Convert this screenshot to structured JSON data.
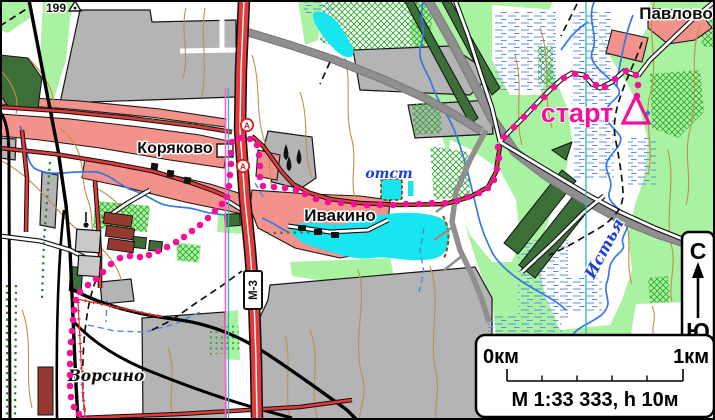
{
  "map": {
    "place_labels": {
      "pavlovo": "Павлово",
      "koryakovo": "Коряково",
      "ivakino": "Ивакино",
      "vorsino": "Ворсино"
    },
    "other_labels": {
      "elevation_point": "199",
      "highway_label": "М-3",
      "start_label": "старт",
      "pond_label": "отст",
      "river_label": "Истья"
    },
    "bus_stop_letter": "А",
    "route": {
      "color": "#f5109b",
      "start_triangle": [
        [
          636,
          96
        ],
        [
          649,
          123
        ],
        [
          623,
          123
        ]
      ],
      "points": [
        [
          637,
          96
        ],
        [
          638,
          85
        ],
        [
          636,
          75
        ],
        [
          626,
          71
        ],
        [
          615,
          79
        ],
        [
          605,
          87
        ],
        [
          596,
          85
        ],
        [
          586,
          77
        ],
        [
          575,
          74
        ],
        [
          564,
          78
        ],
        [
          554,
          87
        ],
        [
          544,
          97
        ],
        [
          534,
          107
        ],
        [
          524,
          117
        ],
        [
          514,
          127
        ],
        [
          504,
          137
        ],
        [
          498,
          147
        ],
        [
          499,
          158
        ],
        [
          497,
          169
        ],
        [
          494,
          180
        ],
        [
          488,
          188
        ],
        [
          479,
          193
        ],
        [
          468,
          197
        ],
        [
          457,
          201
        ],
        [
          445,
          203
        ],
        [
          432,
          203
        ],
        [
          419,
          204
        ],
        [
          406,
          204
        ],
        [
          393,
          205
        ],
        [
          380,
          205
        ],
        [
          367,
          205
        ],
        [
          354,
          204
        ],
        [
          341,
          203
        ],
        [
          328,
          202
        ],
        [
          316,
          199
        ],
        [
          305,
          194
        ],
        [
          296,
          190
        ],
        [
          285,
          188
        ],
        [
          274,
          187
        ],
        [
          263,
          186
        ],
        [
          260,
          177
        ],
        [
          260,
          166
        ],
        [
          259,
          155
        ],
        [
          257,
          145
        ],
        [
          250,
          139
        ],
        [
          240,
          138
        ],
        [
          232,
          142
        ],
        [
          231,
          153
        ],
        [
          231,
          164
        ],
        [
          230,
          175
        ],
        [
          229,
          186
        ],
        [
          227,
          197
        ],
        [
          222,
          204
        ],
        [
          215,
          211
        ],
        [
          208,
          218
        ],
        [
          200,
          225
        ],
        [
          192,
          231
        ],
        [
          184,
          237
        ],
        [
          176,
          242
        ],
        [
          167,
          247
        ],
        [
          158,
          251
        ],
        [
          149,
          255
        ],
        [
          140,
          257
        ],
        [
          130,
          256
        ],
        [
          120,
          258
        ],
        [
          111,
          264
        ],
        [
          103,
          272
        ],
        [
          96,
          279
        ],
        [
          88,
          285
        ],
        [
          80,
          292
        ],
        [
          76,
          300
        ],
        [
          74,
          310
        ],
        [
          73,
          320
        ],
        [
          72,
          331
        ],
        [
          71,
          342
        ],
        [
          70,
          353
        ],
        [
          70,
          364
        ],
        [
          70,
          375
        ],
        [
          70,
          386
        ],
        [
          71,
          397
        ],
        [
          74,
          407
        ],
        [
          79,
          414
        ],
        [
          85,
          419
        ]
      ]
    },
    "colors": {
      "route_magenta": "#f5109b",
      "water_cyan": "#17e6f0",
      "river_blue": "#3677e8",
      "forest_light_green": "#a9f2a1",
      "plantation_dark_green": "#3c6e38",
      "village_pink": "#f2928b",
      "industrial_gray": "#b4b4b4",
      "contour_brown": "#c09048",
      "highway_red": "#e23a3a",
      "sheet_line_teal": "#2ab8b8",
      "sheet_line_pink": "#ff5fd1"
    }
  },
  "scale_panel": {
    "left": "0км",
    "right": "1км",
    "text": "М 1:33 333, h 10м"
  },
  "compass_panel": {
    "north": "С",
    "south": "Ю"
  }
}
